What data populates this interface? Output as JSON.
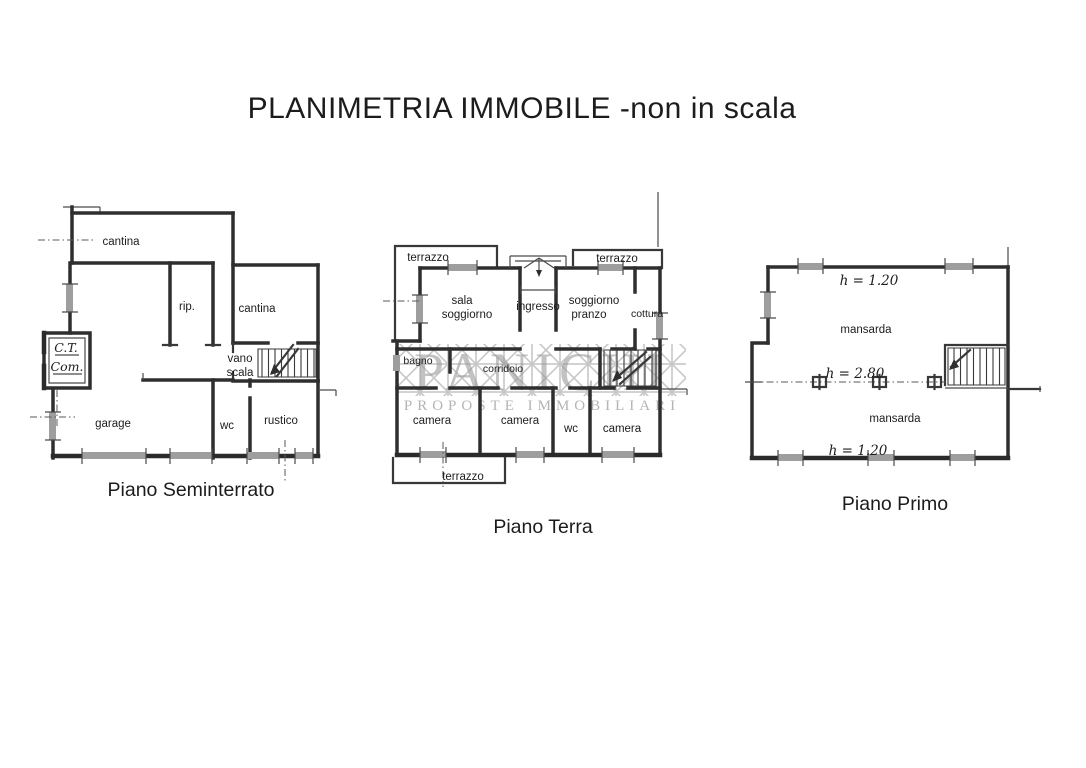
{
  "title": "PLANIMETRIA IMMOBILE -non in scala",
  "watermark": {
    "name": "PANICHI",
    "tagline": "PROPOSTE IMMOBILIARI"
  },
  "colors": {
    "ink": "#2e2e2e",
    "window_fill": "#9e9e9e",
    "watermark_gray": "#b4b4b4",
    "background": "#ffffff"
  },
  "floors": {
    "seminterrato": {
      "label": "Piano Seminterrato",
      "rooms": {
        "cantina_top": "cantina",
        "rip": "rip.",
        "cantina_right": "cantina",
        "ct_line1": "C.T.",
        "ct_line2": "Com.",
        "vano_line1": "vano",
        "vano_line2": "scala",
        "garage": "garage",
        "wc": "wc",
        "rustico": "rustico"
      }
    },
    "terra": {
      "label": "Piano Terra",
      "rooms": {
        "terrazzo_left": "terrazzo",
        "terrazzo_right": "terrazzo",
        "sala_line1": "sala",
        "sala_line2": "soggiorno",
        "ingresso": "ingresso",
        "pranzo_line1": "soggiorno",
        "pranzo_line2": "pranzo",
        "cottura": "cottura",
        "bagno": "bagno",
        "corridoio": "corridoio",
        "camera1": "camera",
        "camera2": "camera",
        "wc": "wc",
        "camera3": "camera",
        "terrazzo_bottom": "terrazzo"
      }
    },
    "primo": {
      "label": "Piano Primo",
      "rooms": {
        "mansarda_top": "mansarda",
        "mansarda_bottom": "mansarda"
      },
      "heights": {
        "top": "h = 1.20",
        "middle": "h = 2.80",
        "bottom": "h = 1.20"
      }
    }
  }
}
